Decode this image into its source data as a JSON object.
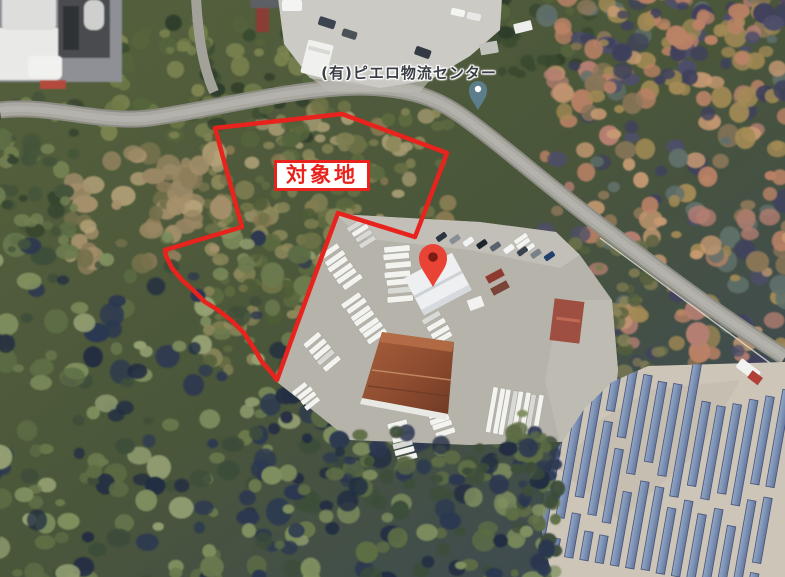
{
  "labels": {
    "poi": "(有)ピエロ物流センター",
    "site": "対象地"
  },
  "markers": {
    "poi_pin": {
      "icon": "place-pin-icon",
      "color": "#5b7e8a",
      "dot_color": "#ffffff"
    },
    "destination_pin": {
      "icon": "destination-pin-icon",
      "color": "#e94335",
      "dot_color": "#7a1e15"
    }
  },
  "annotation": {
    "boundary_color": "#e8231d",
    "site_label_text_color": "#e8231d",
    "site_label_bg": "#ffffff",
    "poi_label_text_color": "#3a3f45"
  }
}
